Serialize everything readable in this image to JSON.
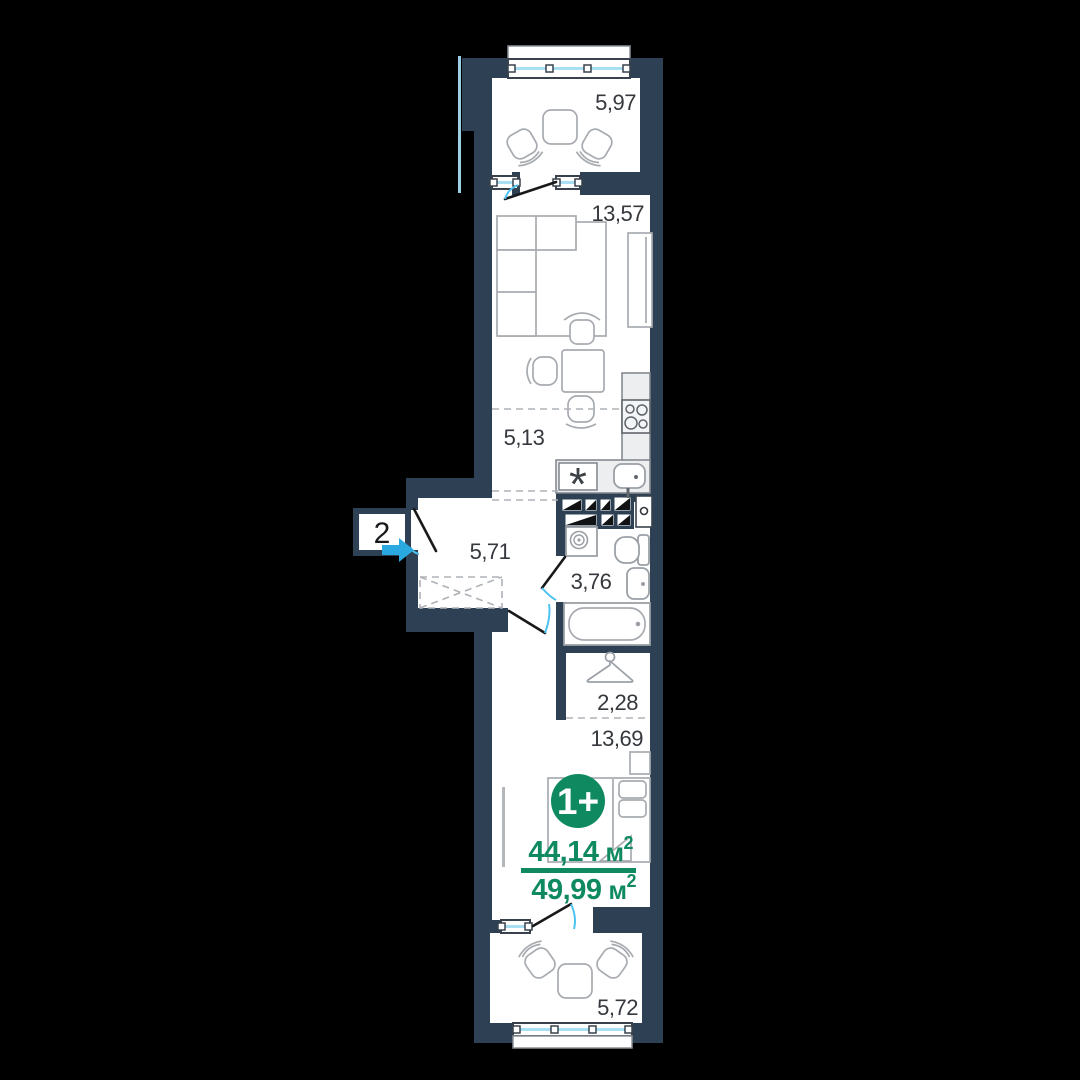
{
  "meta": {
    "background": "#000000",
    "wall_color": "#2e4053",
    "accent_green": "#0f8a60",
    "door_arc_blue": "#4fc3f0",
    "entrance_arrow_blue": "#2aa9e0",
    "glazing_blue": "#a9dff2",
    "label_color": "#35383d"
  },
  "unit": {
    "badge_label": "1+",
    "area_living_value": "44,14",
    "area_total_value": "49,99",
    "area_unit": "м",
    "area_superscript": "2"
  },
  "entrance": {
    "section_number": "2"
  },
  "rooms": {
    "balcony_top": "5,97",
    "living_room": "13,57",
    "kitchen": "5,13",
    "hallway": "5,71",
    "bathroom": "3,76",
    "closet": "2,28",
    "bedroom": "13,69",
    "balcony_bottom": "5,72"
  },
  "icons": {
    "fridge_marker": "*",
    "hanger": "clothes-hanger",
    "washing_machine": "washing-machine-spiral",
    "stove": "four-burner-stove",
    "kitchen_sink": "kitchen-sink",
    "bathtub": "bathtub",
    "toilet": "toilet",
    "washbasin": "washbasin",
    "entrance_arrow": "right-arrow"
  }
}
